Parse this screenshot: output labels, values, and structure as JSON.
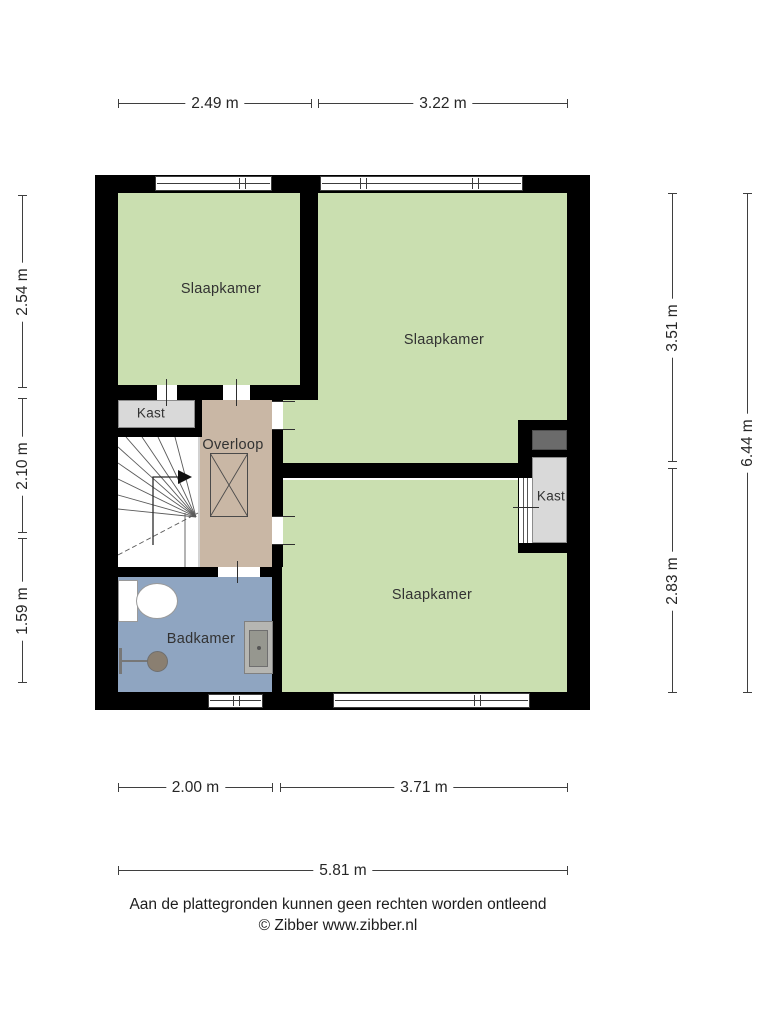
{
  "dimensions": {
    "top": [
      {
        "label": "2.49 m"
      },
      {
        "label": "3.22 m"
      }
    ],
    "left": [
      {
        "label": "2.54 m"
      },
      {
        "label": "2.10 m"
      },
      {
        "label": "1.59 m"
      }
    ],
    "right_inner": [
      {
        "label": "3.51 m"
      },
      {
        "label": "2.83 m"
      }
    ],
    "right_outer": {
      "label": "6.44 m"
    },
    "bottom": [
      {
        "label": "2.00 m"
      },
      {
        "label": "3.71 m"
      }
    ],
    "bottom_total": {
      "label": "5.81 m"
    }
  },
  "rooms": {
    "bedroom_top_left": {
      "label": "Slaapkamer"
    },
    "bedroom_top_right": {
      "label": "Slaapkamer"
    },
    "bedroom_bottom": {
      "label": "Slaapkamer"
    },
    "closet_left": {
      "label": "Kast"
    },
    "closet_right": {
      "label": "Kast"
    },
    "landing": {
      "label": "Overloop"
    },
    "bathroom": {
      "label": "Badkamer"
    }
  },
  "footer": {
    "disclaimer": "Aan de plattegronden kunnen geen rechten worden ontleend",
    "credit": "© Zibber www.zibber.nl"
  },
  "colors": {
    "room_green": "#cadfb0",
    "landing_tan": "#c9b7a5",
    "bathroom_blue": "#8fa5c1",
    "closet_gray": "#d9d9d9",
    "duct_gray": "#6b6b6b",
    "wall_black": "#000000"
  }
}
